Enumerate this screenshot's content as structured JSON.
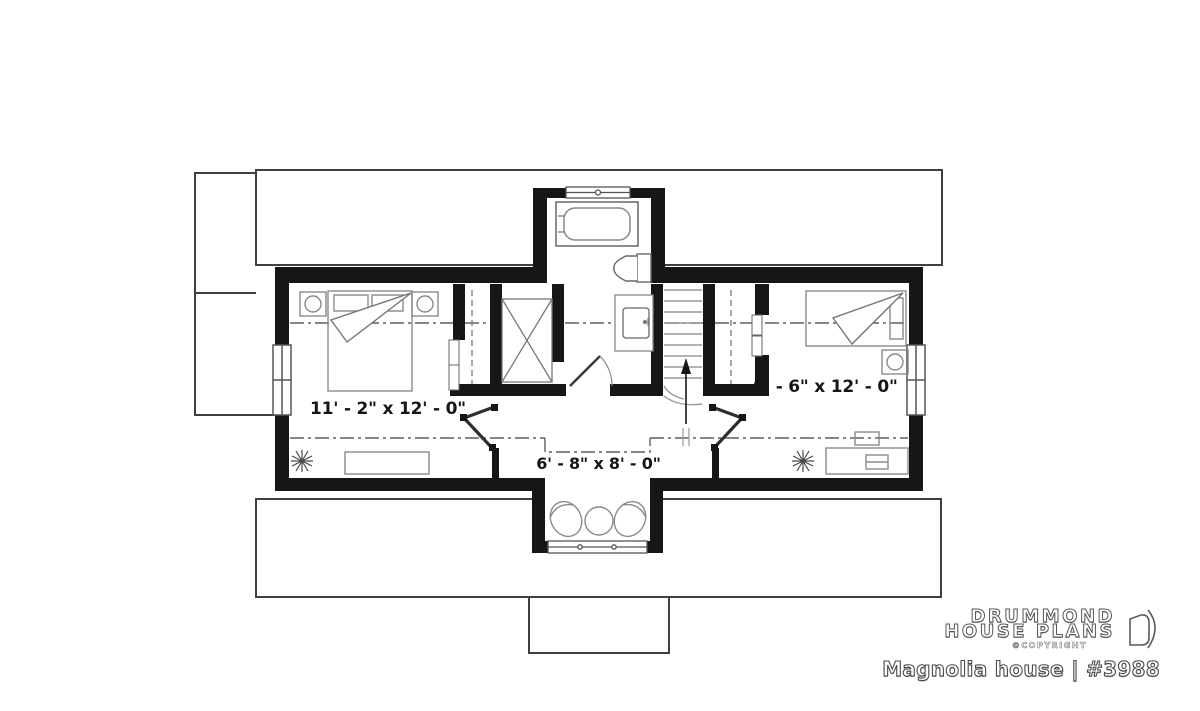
{
  "branding": {
    "logo_line1": "DRUMMOND",
    "logo_line2": "HOUSE PLANS",
    "copyright_label": "©COPYRIGHT",
    "plan_title": "Magnolia house | #3988"
  },
  "rooms": {
    "left_bedroom": {
      "dimension": "11' - 2\" x 12' - 0\""
    },
    "sitting_area": {
      "dimension": "6' - 8\" x 8' - 0\""
    },
    "right_bedroom": {
      "dimension": "9' - 6\" x 12' - 0\""
    }
  },
  "colors": {
    "wall": "#161616",
    "roofline": "#3f3f3f",
    "centerline": "#5f5f5f",
    "furniture": "#8a8a8a",
    "label_text": "#161616"
  }
}
